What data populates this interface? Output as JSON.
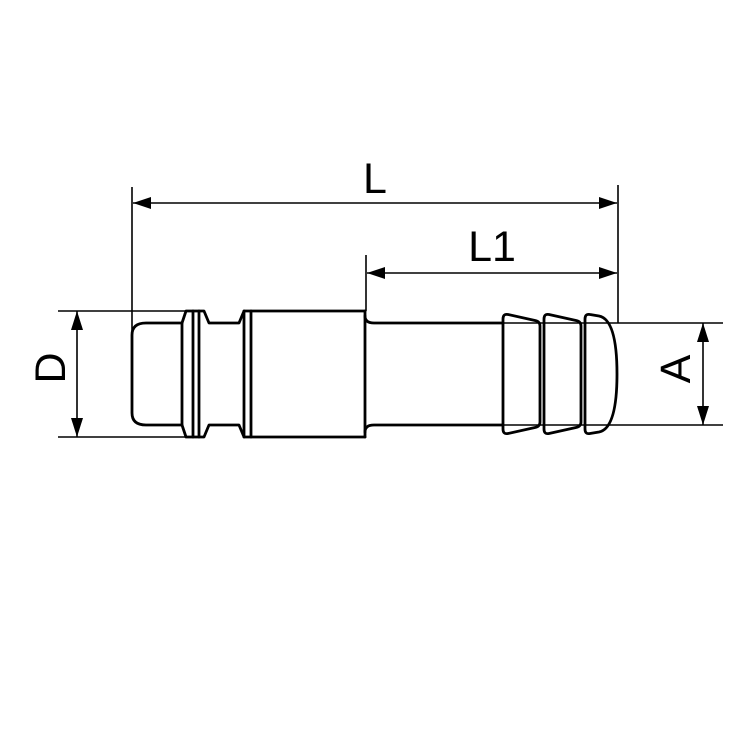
{
  "colors": {
    "background": "#ffffff",
    "line": "#000000",
    "text": "#000000"
  },
  "labels": {
    "overall_length": "L",
    "hose_tail_length": "L1",
    "body_diameter": "D",
    "hose_tail_diameter": "A"
  }
}
